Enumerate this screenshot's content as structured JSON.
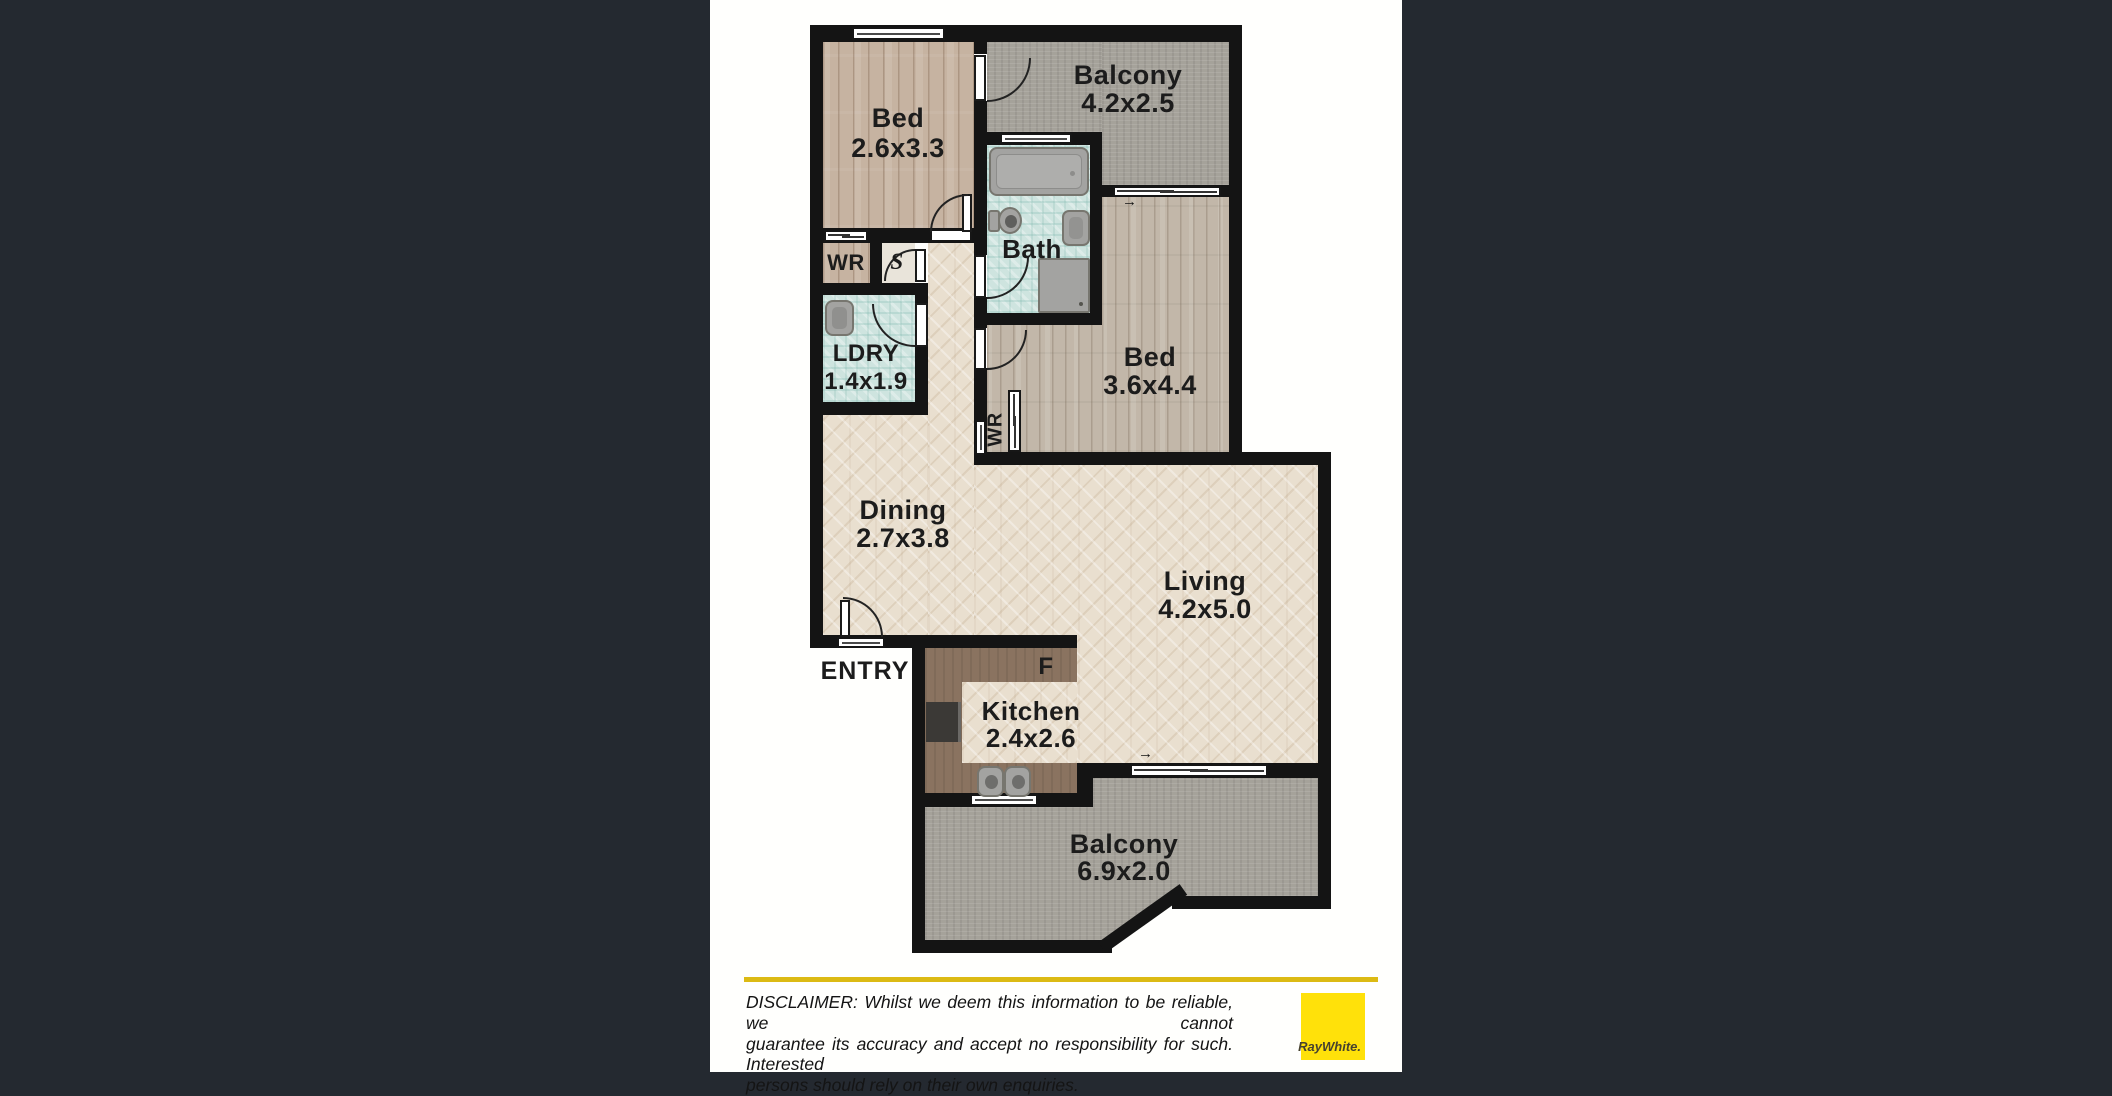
{
  "plan": {
    "rooms": {
      "bed1": {
        "name": "Bed",
        "dims": "2.6x3.3"
      },
      "balcony_top": {
        "name": "Balcony",
        "dims": "4.2x2.5"
      },
      "bath": {
        "name": "Bath"
      },
      "bed2": {
        "name": "Bed",
        "dims": "3.6x4.4"
      },
      "wardrobe1": {
        "name": "WR"
      },
      "storage": {
        "name": "S"
      },
      "laundry": {
        "name": "LDRY",
        "dims": "1.4x1.9"
      },
      "wardrobe2": {
        "name": "WR"
      },
      "dining": {
        "name": "Dining",
        "dims": "2.7x3.8"
      },
      "living": {
        "name": "Living",
        "dims": "4.2x5.0"
      },
      "entry": {
        "name": "ENTRY"
      },
      "fridge": {
        "name": "F"
      },
      "kitchen": {
        "name": "Kitchen",
        "dims": "2.4x2.6"
      },
      "balcony_bottom": {
        "name": "Balcony",
        "dims": "6.9x2.0"
      }
    },
    "slider_arrow": "→"
  },
  "footer": {
    "disclaimer_line1": "DISCLAIMER: Whilst we deem this information to be reliable, we cannot",
    "disclaimer_line2": "guarantee its accuracy and accept no responsibility for such. Interested",
    "disclaimer_line3": "persons should rely on their own enquiries.",
    "logo_text": "RayWhite."
  },
  "colors": {
    "background": "#242930",
    "wall": "#141414",
    "accent_yellow": "#ffe10a",
    "rule_yellow": "#dcba13",
    "bath_tile": "#cee4df",
    "balcony_gray": "#a5a29a",
    "kitchen_bench": "#8a7360"
  }
}
